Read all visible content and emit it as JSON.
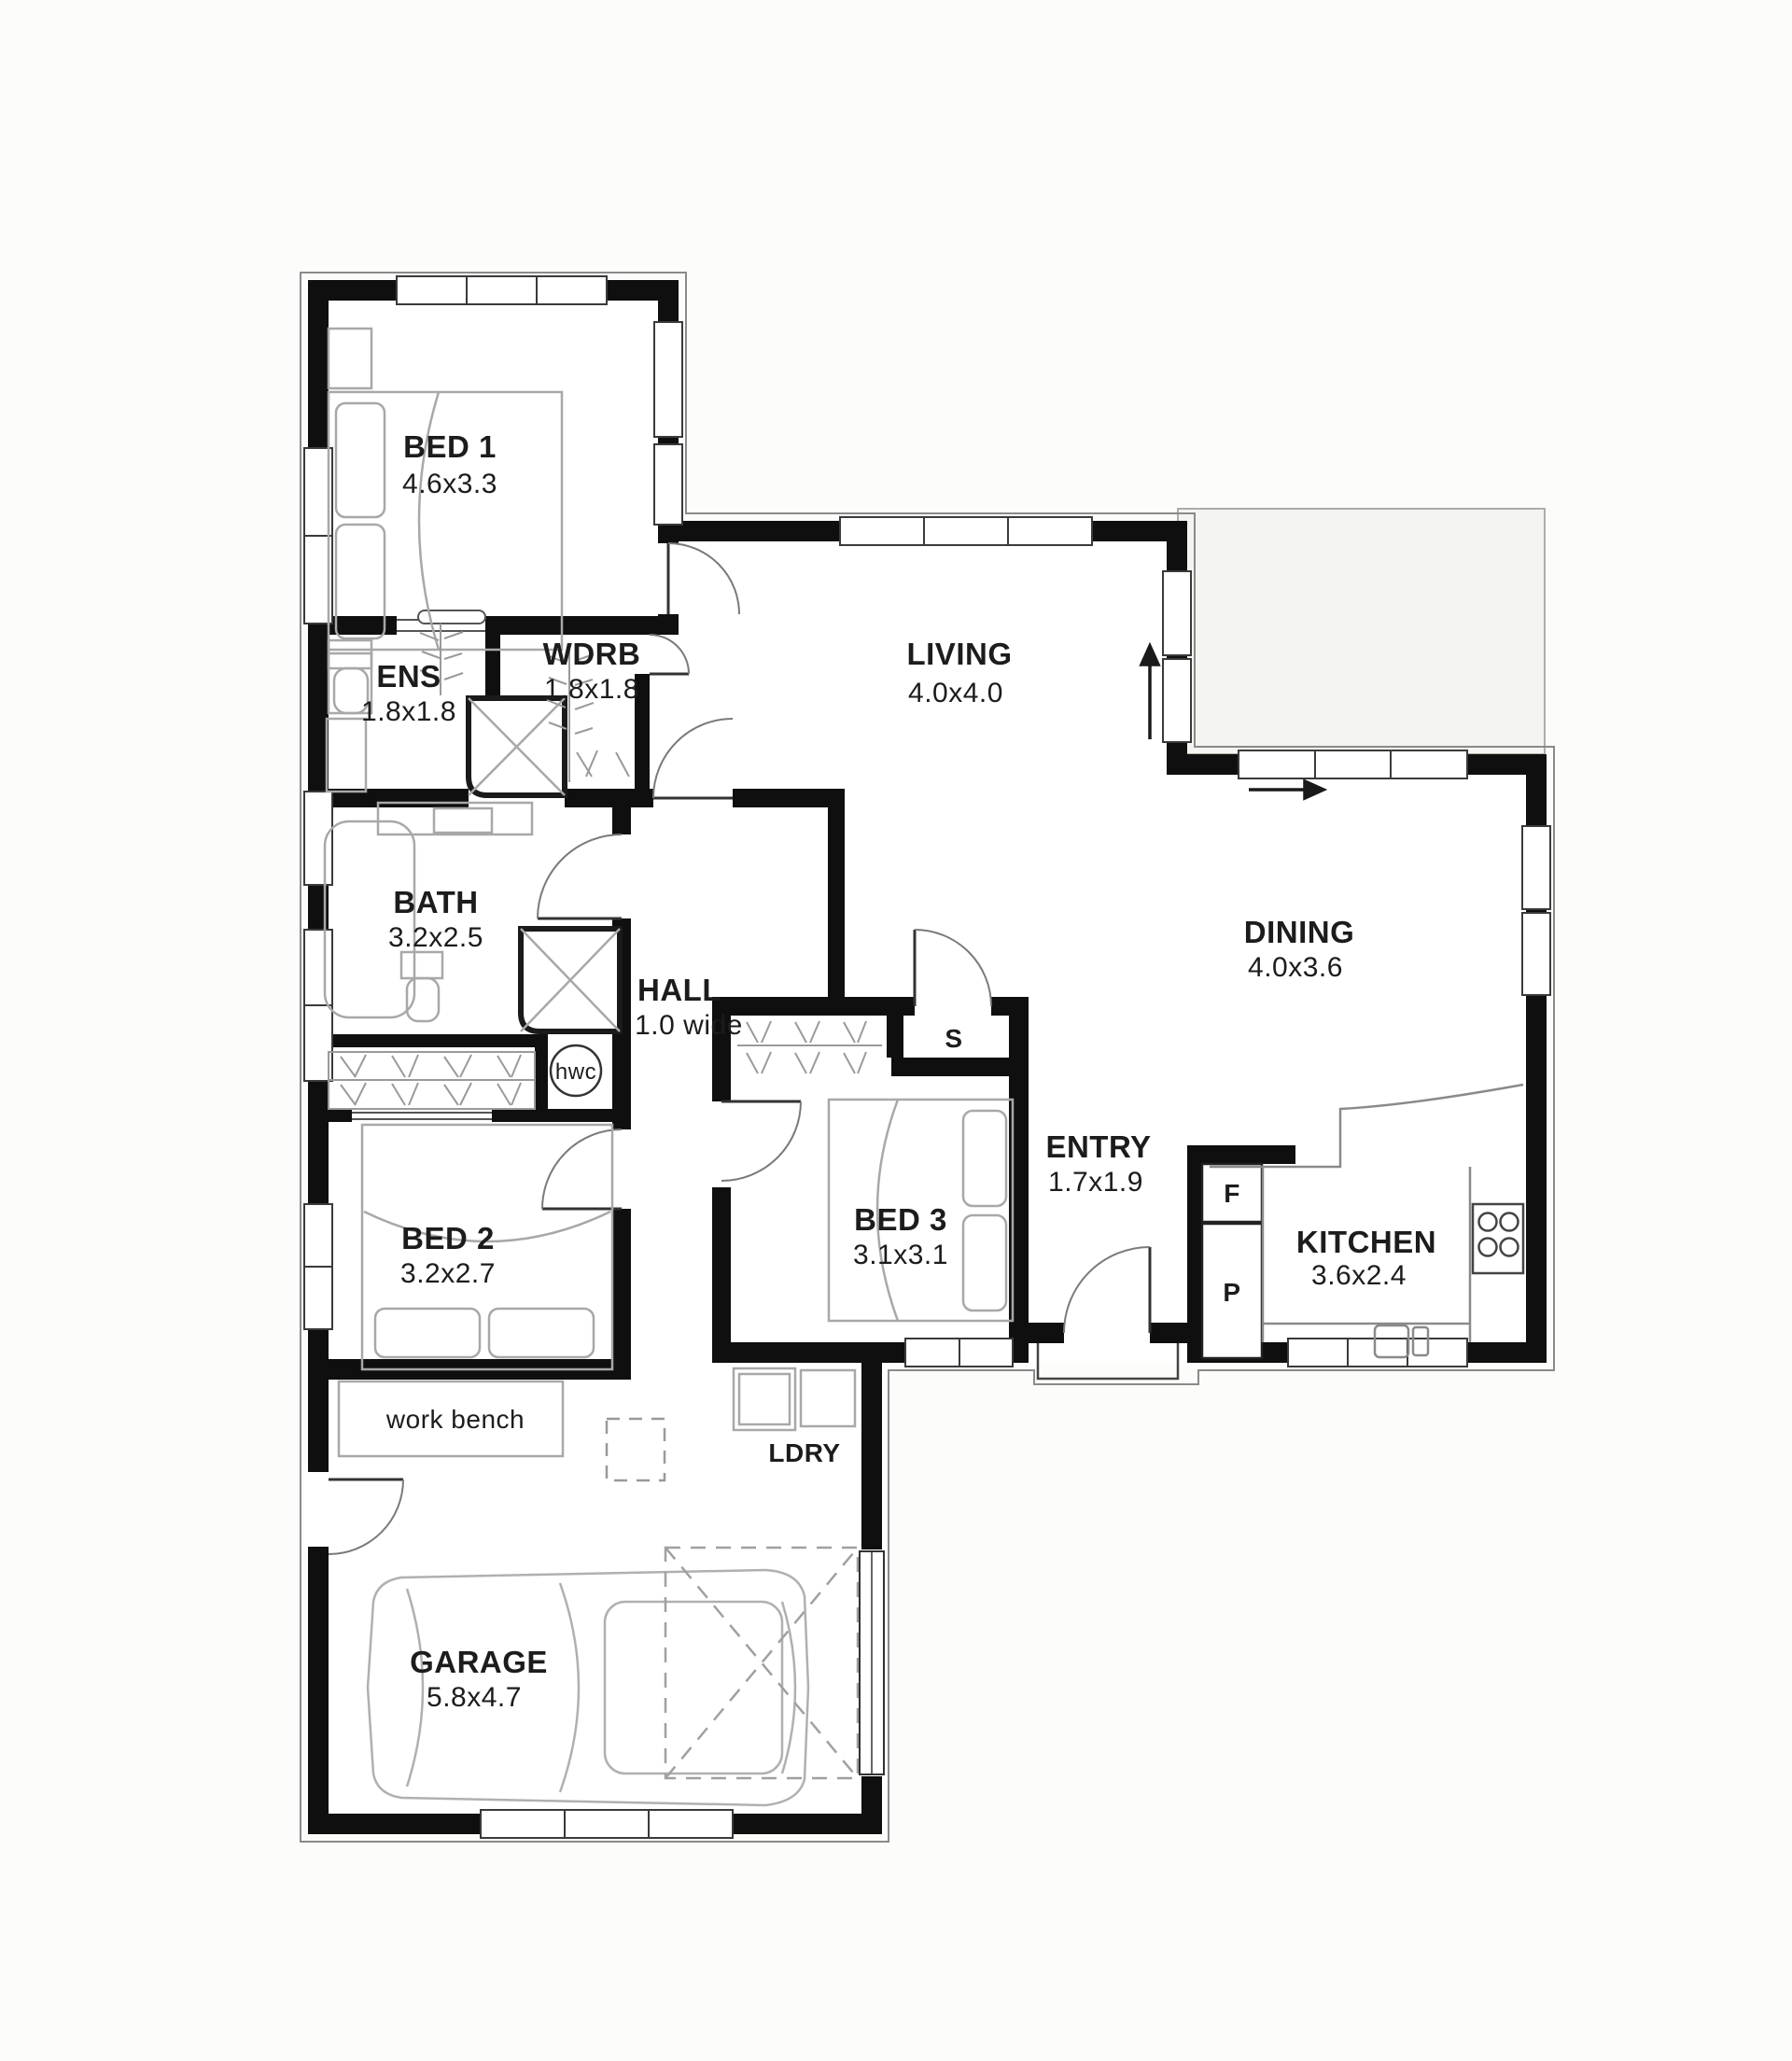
{
  "plan": {
    "type": "floor-plan",
    "rooms": {
      "bed1": {
        "name": "BED 1",
        "dims": "4.6x3.3"
      },
      "ens": {
        "name": "ENS",
        "dims": "1.8x1.8"
      },
      "wdrb": {
        "name": "WDRB",
        "dims": "1.8x1.8"
      },
      "living": {
        "name": "LIVING",
        "dims": "4.0x4.0"
      },
      "bath": {
        "name": "BATH",
        "dims": "3.2x2.5"
      },
      "hall": {
        "name": "HALL",
        "dims": "1.0 wide"
      },
      "dining": {
        "name": "DINING",
        "dims": "4.0x3.6"
      },
      "bed2": {
        "name": "BED 2",
        "dims": "3.2x2.7"
      },
      "bed3": {
        "name": "BED 3",
        "dims": "3.1x3.1"
      },
      "entry": {
        "name": "ENTRY",
        "dims": "1.7x1.9"
      },
      "kitchen": {
        "name": "KITCHEN",
        "dims": "3.6x2.4"
      },
      "garage": {
        "name": "GARAGE",
        "dims": "5.8x4.7"
      },
      "ldry": {
        "name": "LDRY"
      }
    },
    "fixtures": {
      "hot_water_cylinder": "hwc",
      "storage": "S",
      "fridge": "F",
      "pantry": "P",
      "workbench": "work bench"
    },
    "colors": {
      "wall": "#0f0f0f",
      "furniture": "#a8a8a8",
      "background": "#fcfcfa",
      "deck": "#f4f4f0"
    }
  }
}
